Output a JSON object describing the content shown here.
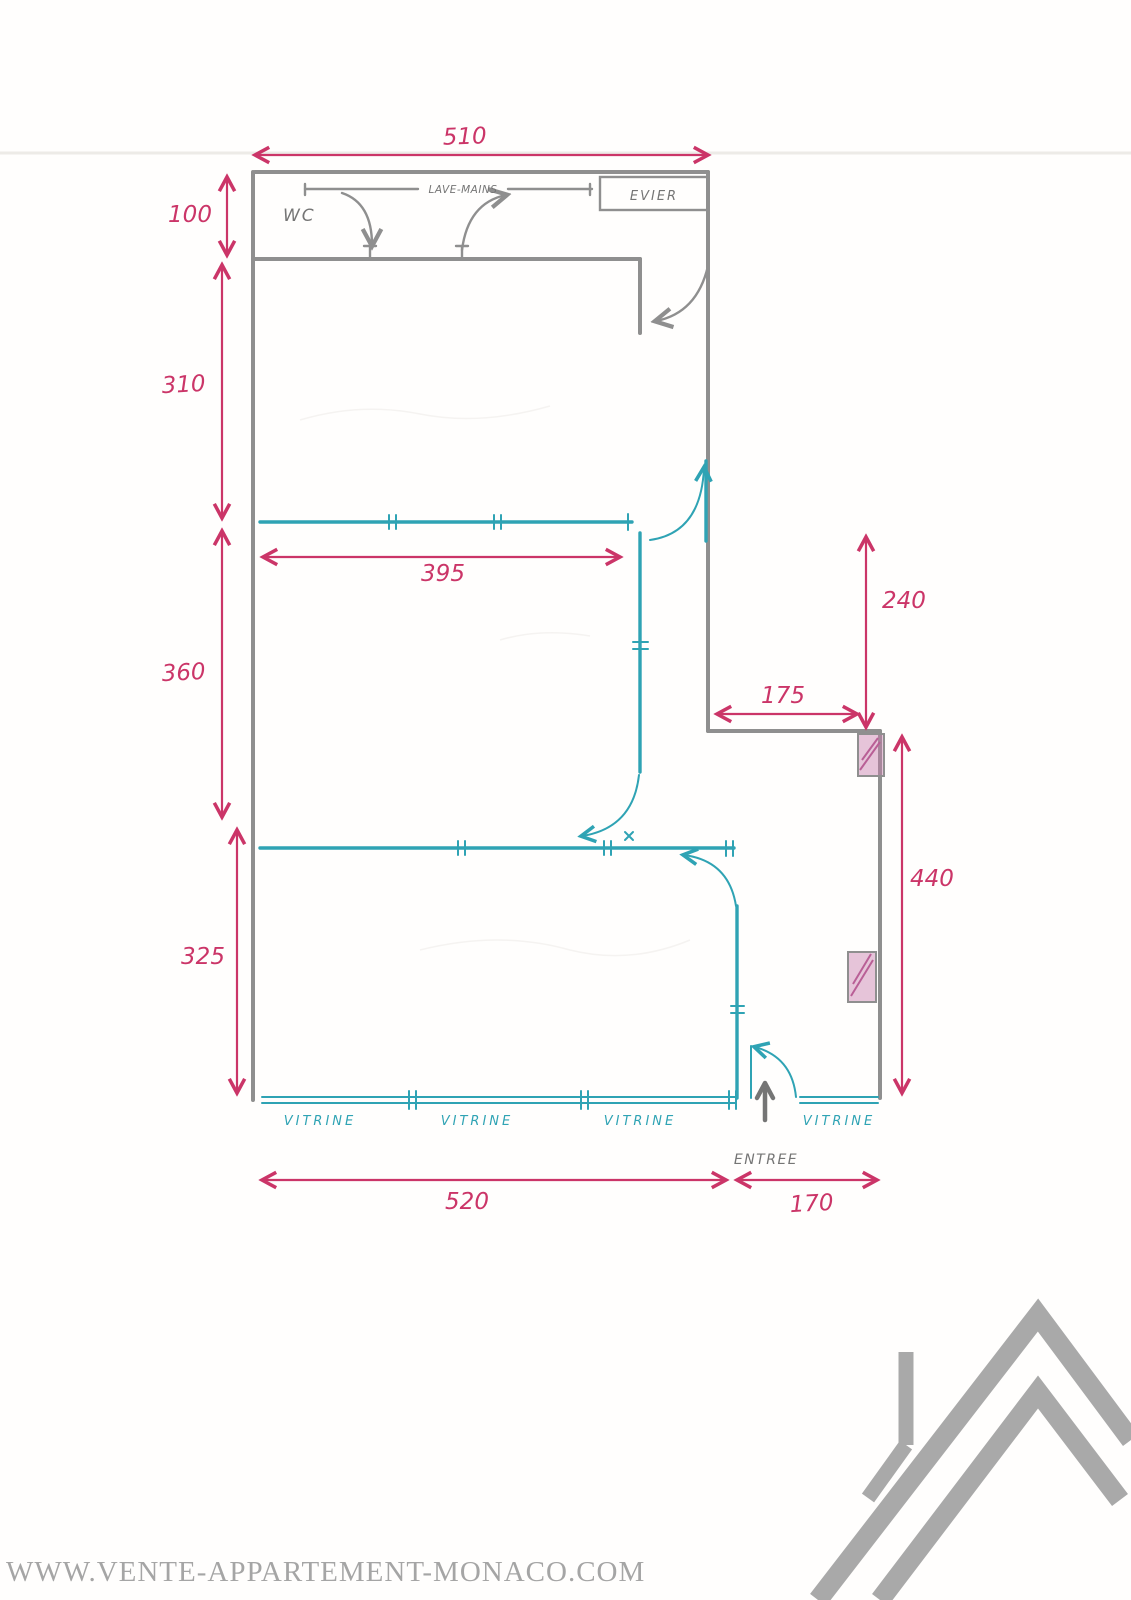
{
  "page": {
    "watermark": "WWW.VENTE-APPARTEMENT-MONACO.COM"
  },
  "labels": {
    "wc": "WC",
    "lave_mains": "LAVE-MAINS",
    "evier": "EVIER",
    "entree": "ENTREE",
    "vitrines": [
      "VITRINE",
      "VITRINE",
      "VITRINE",
      "VITRINE"
    ]
  },
  "dimensions": {
    "top_width": "510",
    "wc_height": "100",
    "room1_height": "310",
    "room2_height": "360",
    "room3_height": "325",
    "room2_width": "395",
    "right_recess_height": "240",
    "recess_width": "175",
    "right_height": "440",
    "front_width": "520",
    "entrance_width": "170"
  },
  "colors": {
    "pink": "#cb3568",
    "teal": "#2fa3b4",
    "wall": "#8f8f8f",
    "label": "#757575",
    "pillar": "#c77fae",
    "watermark": "#a5a5a5",
    "logo": "#a9a9a9"
  }
}
